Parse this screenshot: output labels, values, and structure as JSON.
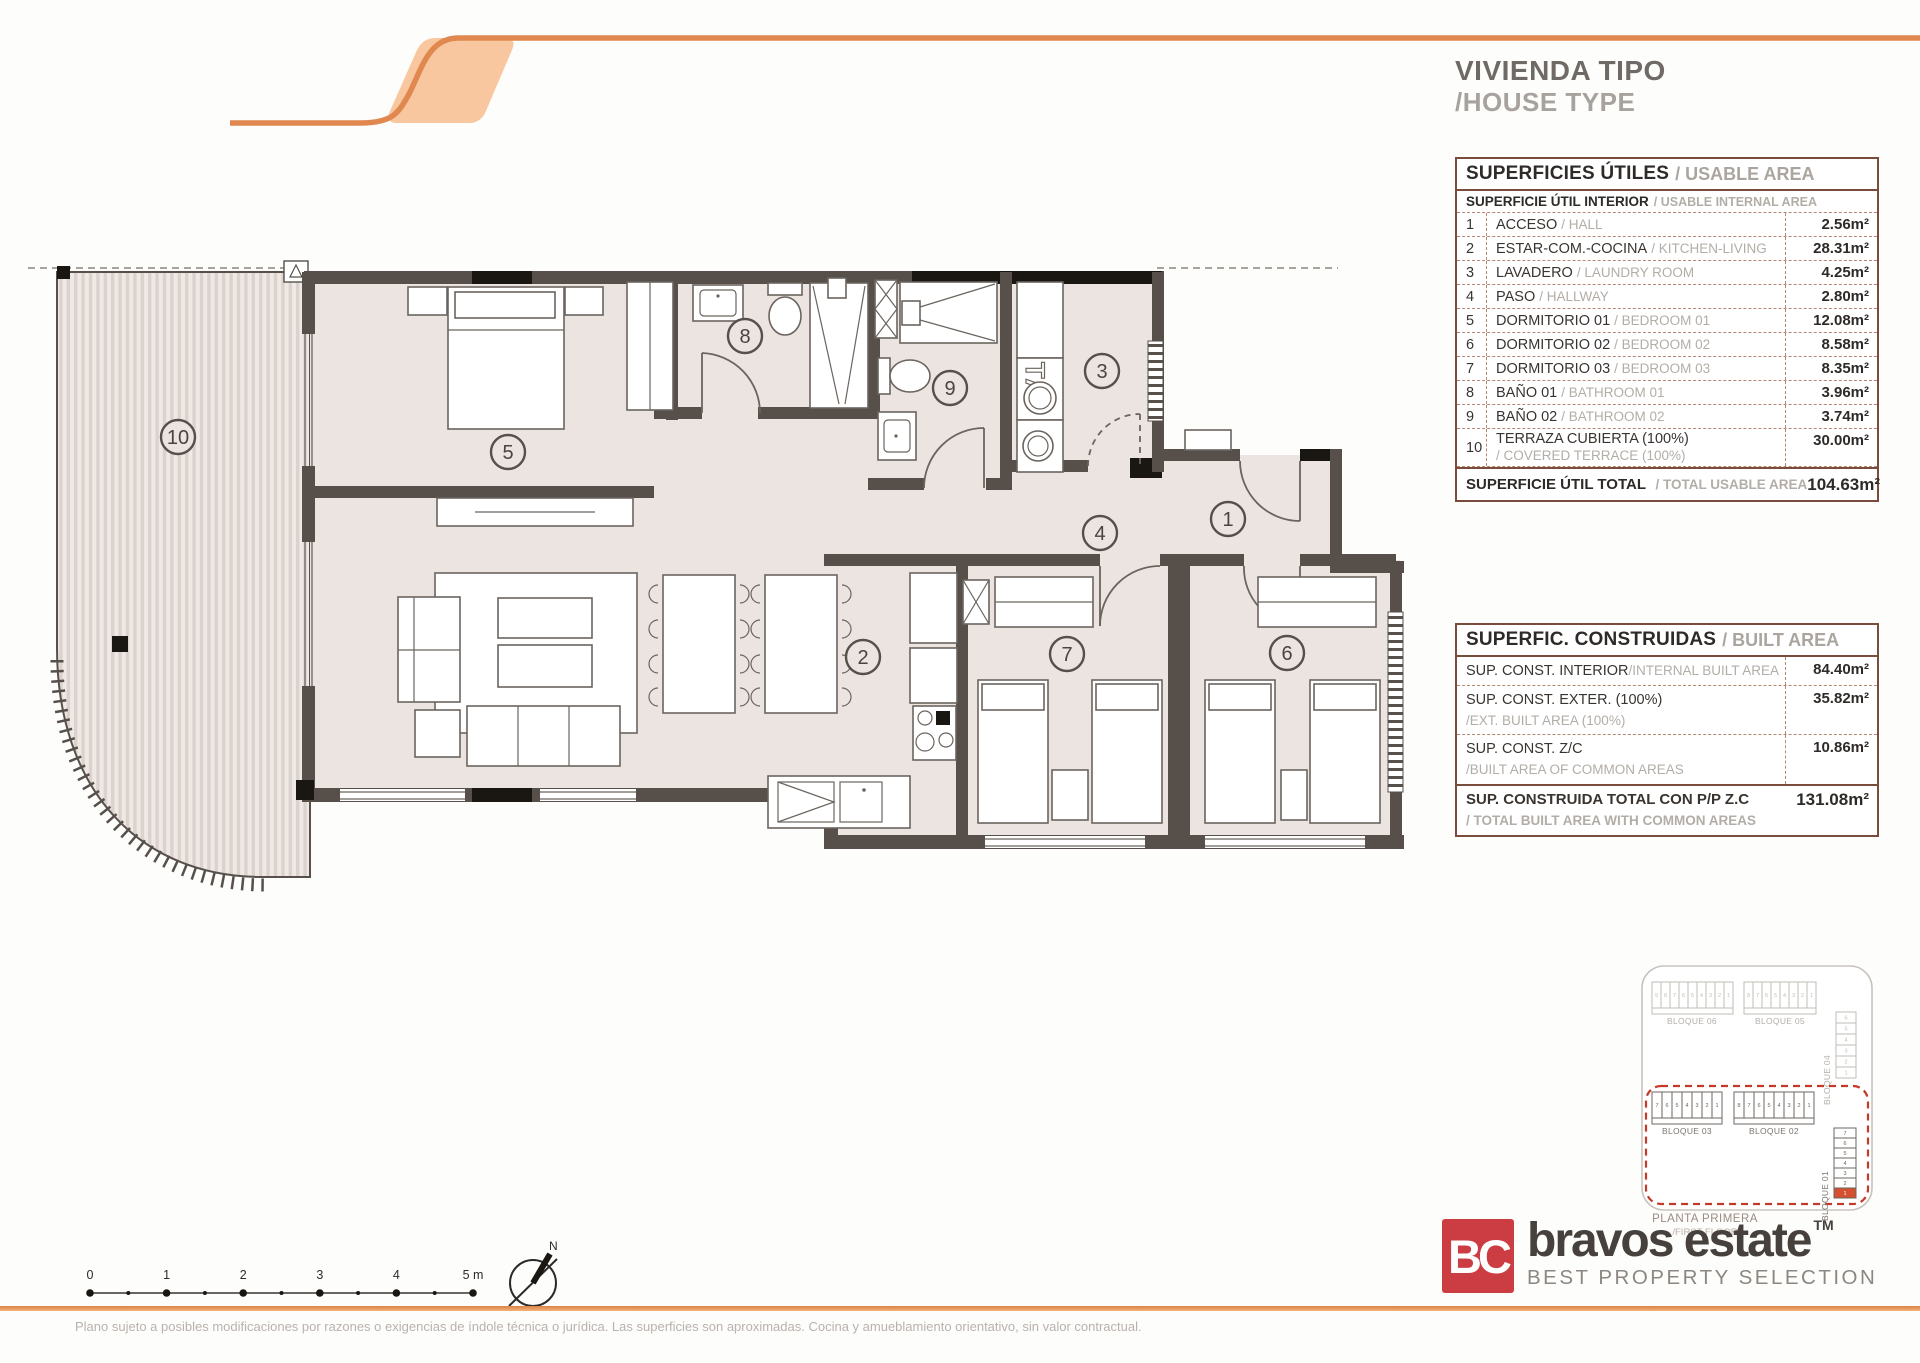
{
  "header": {
    "title_es": "VIVIENDA TIPO",
    "title_en": "/HOUSE TYPE"
  },
  "usable_table": {
    "title_es": "SUPERFICIES ÚTILES",
    "title_en": "/ USABLE AREA",
    "subtitle_es": "SUPERFICIE ÚTIL INTERIOR",
    "subtitle_en": "/ USABLE INTERNAL AREA",
    "rows": [
      {
        "num": "1",
        "name_es": "ACCESO",
        "name_en": "/ HALL",
        "value": "2.56m²"
      },
      {
        "num": "2",
        "name_es": "ESTAR-COM.-COCINA",
        "name_en": "/ KITCHEN-LIVING",
        "value": "28.31m²"
      },
      {
        "num": "3",
        "name_es": "LAVADERO",
        "name_en": "/ LAUNDRY ROOM",
        "value": "4.25m²"
      },
      {
        "num": "4",
        "name_es": "PASO",
        "name_en": "/ HALLWAY",
        "value": "2.80m²"
      },
      {
        "num": "5",
        "name_es": "DORMITORIO 01",
        "name_en": "/ BEDROOM 01",
        "value": "12.08m²"
      },
      {
        "num": "6",
        "name_es": "DORMITORIO 02",
        "name_en": "/ BEDROOM 02",
        "value": "8.58m²"
      },
      {
        "num": "7",
        "name_es": "DORMITORIO 03",
        "name_en": "/ BEDROOM 03",
        "value": "8.35m²"
      },
      {
        "num": "8",
        "name_es": "BAÑO 01",
        "name_en": "/ BATHROOM 01",
        "value": "3.96m²"
      },
      {
        "num": "9",
        "name_es": "BAÑO 02",
        "name_en": "/ BATHROOM 02",
        "value": "3.74m²"
      },
      {
        "num": "10",
        "name_es": "TERRAZA CUBIERTA (100%)",
        "name_en": "/ COVERED TERRACE (100%)",
        "value": "30.00m²"
      }
    ],
    "total_label_es": "SUPERFICIE ÚTIL TOTAL",
    "total_label_en": "/ TOTAL USABLE AREA",
    "total_value": "104.63m²"
  },
  "built_table": {
    "title_es": "SUPERFIC. CONSTRUIDAS",
    "title_en": "/ BUILT AREA",
    "rows": [
      {
        "es": "SUP. CONST. INTERIOR",
        "en": "/INTERNAL BUILT AREA",
        "value": "84.40m²"
      },
      {
        "es": "SUP. CONST. EXTER. (100%)",
        "en": "/EXT. BUILT AREA (100%)",
        "value": "35.82m²"
      },
      {
        "es": "SUP. CONST. Z/C",
        "en": "/BUILT AREA OF COMMON AREAS",
        "value": "10.86m²"
      }
    ],
    "total_es": "SUP. CONSTRUIDA TOTAL CON P/P Z.C",
    "total_en": "/ TOTAL BUILT AREA WITH COMMON AREAS",
    "total_value": "131.08m²"
  },
  "plan": {
    "rooms": [
      "1",
      "2",
      "3",
      "4",
      "5",
      "6",
      "7",
      "8",
      "9",
      "10"
    ],
    "ta_label": "TA"
  },
  "scale_bar": {
    "labels": [
      "0",
      "1",
      "2",
      "3",
      "4",
      "5 m"
    ]
  },
  "compass": {
    "north_label": "N"
  },
  "locator": {
    "blocks": [
      {
        "label": "BLOQUE 06",
        "cells": [
          "9",
          "8",
          "7",
          "6",
          "5",
          "4",
          "3",
          "2",
          "1"
        ]
      },
      {
        "label": "BLOQUE 05",
        "cells": [
          "8",
          "7",
          "6",
          "5",
          "4",
          "3",
          "2",
          "1"
        ]
      },
      {
        "label": "BLOQUE 04",
        "cells": [
          "6",
          "5",
          "4",
          "3",
          "2",
          "1"
        ]
      },
      {
        "label": "BLOQUE 03",
        "cells": [
          "7",
          "6",
          "5",
          "4",
          "3",
          "2",
          "1"
        ]
      },
      {
        "label": "BLOQUE 02",
        "cells": [
          "8",
          "7",
          "6",
          "5",
          "4",
          "3",
          "2",
          "1"
        ]
      },
      {
        "label": "BLOQUE 01",
        "cells": [
          "7",
          "6",
          "5",
          "4",
          "3",
          "2",
          "1"
        ]
      }
    ],
    "floor_es": "PLANTA PRIMERA",
    "floor_en": "/FIRST FLOOR"
  },
  "logo": {
    "monogram": "BC",
    "name": "bravos estate",
    "tm": "TM",
    "tagline": "BEST PROPERTY SELECTION"
  },
  "footer": {
    "disclaimer": "Plano sujeto a posibles modificaciones por razones o exigencias de índole técnica o jurídica. Las superficies son aproximadas. Cocina y amueblamiento orientativo, sin valor contractual."
  },
  "colors": {
    "accent_orange": "#E0884F",
    "accent_orange_fill": "#F8C7A0",
    "wall": "#57504A",
    "floor": "#ECE4E1",
    "table_border": "#7A4C3C",
    "logo_red": "#CB3D42",
    "locator_highlight": "#D4502E"
  }
}
